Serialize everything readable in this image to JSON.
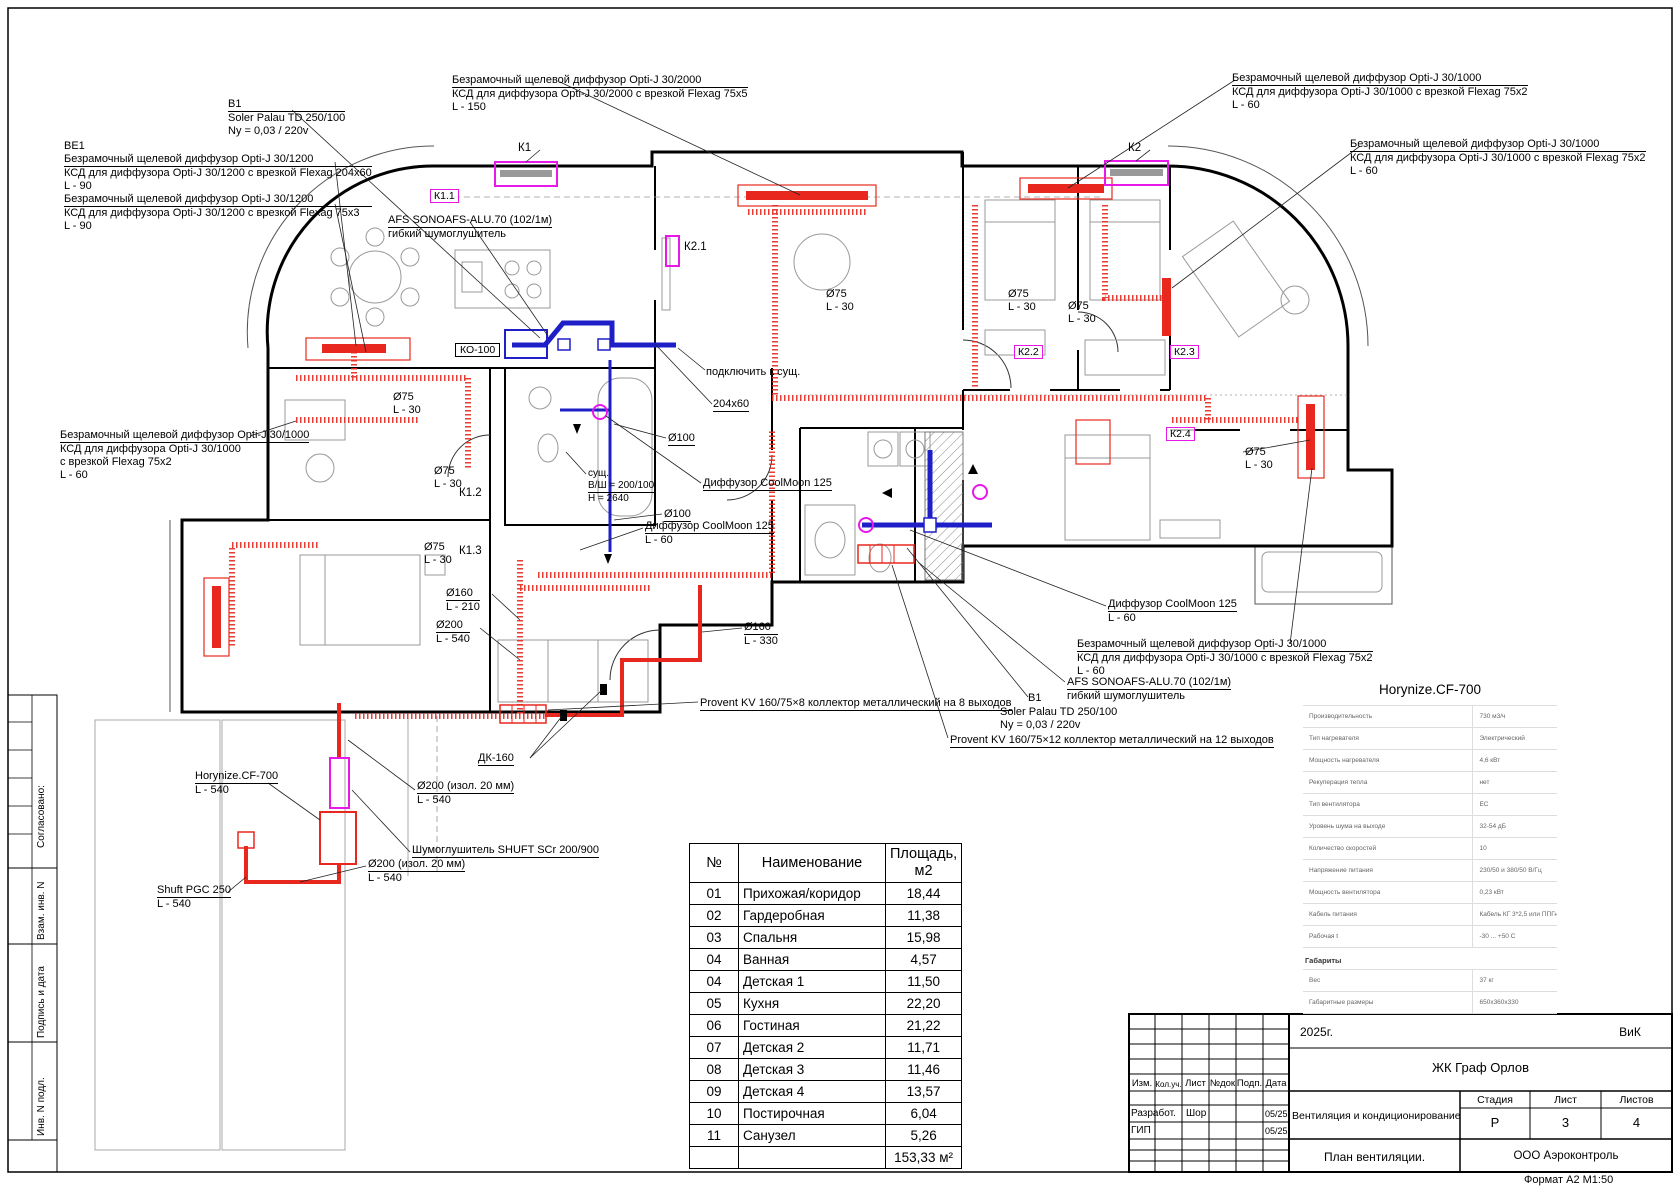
{
  "sheet": {
    "format_note": "Формат А2 М1:50"
  },
  "side_strip": {
    "labels": [
      "Согласовано:",
      "Взам. инв. N",
      "Подпись и дата",
      "Инв. N подл."
    ]
  },
  "plan_labels": {
    "k1": "К1",
    "k1_1": "К1.1",
    "k1_2": "К1.2",
    "k1_3": "К1.3",
    "k2": "К2",
    "k2_1": "К2.1",
    "k2_2": "К2.2",
    "k2_3": "К2.3",
    "k2_4": "К2.4",
    "ko100": "КО-100"
  },
  "annotations": {
    "b1_top": [
      "_B1",
      "Soler Palau TD 250/100",
      "Ny = 0,03  / 220v"
    ],
    "be1": [
      "BE1",
      "_Безрамочный щелевой диффузор Opti-J 30/1200",
      "КСД для диффузора Opti-J 30/1200 с врезкой Flexag 204x60",
      "L - 90",
      "_Безрамочный щелевой диффузор Opti-J 30/1200",
      "КСД для диффузора Opti-J 30/1200 с врезкой Flexag 75x3",
      "L - 90"
    ],
    "top_center": [
      "_Безрамочный щелевой диффузор Opti-J 30/2000",
      "КСД для диффузора Opti-J 30/2000 с врезкой Flexag 75x5",
      "L - 150"
    ],
    "top_right1": [
      "_Безрамочный щелевой диффузор Opti-J 30/1000",
      "КСД для диффузора Opti-J 30/1000 с врезкой Flexag 75x2",
      "L - 60"
    ],
    "top_right2": [
      "_Безрамочный щелевой диффузор Opti-J 30/1000",
      "КСД для диффузора Opti-J 30/1000 с врезкой Flexag 75x2",
      "L - 60"
    ],
    "afs_top": [
      "_AFS SONOAFS-ALU.70 (102/1м)",
      "гибкий шумоглушитель"
    ],
    "mid_left": [
      "_Безрамочный щелевой диффузор Opti-J 30/1000",
      "КСД для диффузора Opti-J 30/1000",
      "с врезкой Flexag 75x2",
      "L - 60"
    ],
    "connect": [
      "подключить к сущ."
    ],
    "size204": [
      "_204x60"
    ],
    "susch": [
      "сущ.",
      "_В/Ш = 200/100",
      "Н = 2640"
    ],
    "d100": [
      "_Ø100"
    ],
    "coolmoon_single": [
      "_Диффузор CoolMoon 125"
    ],
    "coolmoon_pair": [
      "_Диффузор CoolMoon 125",
      "L - 60"
    ],
    "d75": [
      "Ø75",
      "L - 30"
    ],
    "d160_210": [
      "_Ø160",
      "L - 210"
    ],
    "d200_540": [
      "_Ø200",
      "L - 540"
    ],
    "d160_330": [
      "_Ø160",
      "L - 330"
    ],
    "dk160": [
      "_ДК-160"
    ],
    "provent8": [
      "_Provent KV 160/75×8 коллектор металлический на 8 выходов"
    ],
    "diff_bottom": [
      "_Безрамочный щелевой диффузор Opti-J 30/1000",
      "КСД для диффузора Opti-J 30/1000 с врезкой Flexag 75x2",
      "L - 60"
    ],
    "afs_bottom": [
      "_AFS SONOAFS-ALU.70 (102/1м)",
      "гибкий шумоглушитель"
    ],
    "b1_label": [
      "B1"
    ],
    "b1_spec": [
      "Soler Palau TD 250/100",
      "Ny = 0,03  / 220v"
    ],
    "provent12": [
      "_Provent KV 160/75×12 коллектор металлический на 12 выходов"
    ],
    "horynize": [
      "_Horynize.CF-700",
      "L - 540"
    ],
    "shuft_pgc": [
      "_Shuft PGC 250",
      "L - 540"
    ],
    "d200_izol": [
      "_Ø200 (изол. 20 мм)",
      "L - 540"
    ],
    "silencer": [
      "_Шумоглушитель SHUFT SCr 200/900"
    ]
  },
  "room_table": {
    "headers": [
      "№",
      "Наименование",
      "Площадь,\nм2"
    ],
    "rows": [
      [
        "01",
        "Прихожая/коридор",
        "18,44"
      ],
      [
        "02",
        "Гардеробная",
        "11,38"
      ],
      [
        "03",
        "Спальня",
        "15,98"
      ],
      [
        "04",
        "Ванная",
        "4,57"
      ],
      [
        "04",
        "Детская 1",
        "11,50"
      ],
      [
        "05",
        "Кухня",
        "22,20"
      ],
      [
        "06",
        "Гостиная",
        "21,22"
      ],
      [
        "07",
        "Детская 2",
        "11,71"
      ],
      [
        "08",
        "Детская 3",
        "11,46"
      ],
      [
        "09",
        "Детская 4",
        "13,57"
      ],
      [
        "10",
        "Постирочная",
        "6,04"
      ],
      [
        "11",
        "Санузел",
        "5,26"
      ],
      [
        "",
        "",
        "153,33 м²"
      ]
    ]
  },
  "spec_table": {
    "title": "Horynize.CF-700",
    "rows": [
      [
        "Производительность",
        "730 м3/ч"
      ],
      [
        "Тип нагревателя",
        "Электрический"
      ],
      [
        "Мощность нагревателя",
        "4,6 кВт"
      ],
      [
        "Рекуперация тепла",
        "нет"
      ],
      [
        "Тип вентилятора",
        "ЕС"
      ],
      [
        "Уровень шума на выходе",
        "32-54 дБ"
      ],
      [
        "Количество скоростей",
        "10"
      ],
      [
        "Напряжение питания",
        "230/50 и 380/50 В/Гц"
      ],
      [
        "Мощность вентилятора",
        "0,23 кВт"
      ],
      [
        "Кабель питания",
        "Кабель КГ 3*2,5 или ППГнг 3*2,5 (КГ 5*1,5 или ВВГнг 5*1,5 мм2)"
      ],
      [
        "Рабочая t",
        "-30 ... +50 С"
      ]
    ],
    "dimensions_header": "Габариты",
    "dimensions_rows": [
      [
        "Вес",
        "37 кг"
      ],
      [
        "Габаритные размеры",
        "650х360х330"
      ]
    ]
  },
  "title_block": {
    "year": "2025г.",
    "code": "ВиК",
    "project": "ЖК Граф Орлов",
    "cols": [
      "Изм.",
      "Кол.уч.",
      "Лист",
      "№док",
      "Подп.",
      "Дата"
    ],
    "sign_rows": [
      {
        "role": "Разработ.",
        "name": "Шор",
        "date": "05/25"
      },
      {
        "role": "ГИП",
        "name": "",
        "date": "05/25"
      }
    ],
    "section": "Вентиляция и кондиционирование",
    "stage_label": "Стадия",
    "sheet_label": "Лист",
    "sheets_label": "Листов",
    "stage": "Р",
    "sheet": "3",
    "sheets": "4",
    "drawing_title": "План вентиляции.",
    "company": "ООО Аэроконтроль"
  }
}
